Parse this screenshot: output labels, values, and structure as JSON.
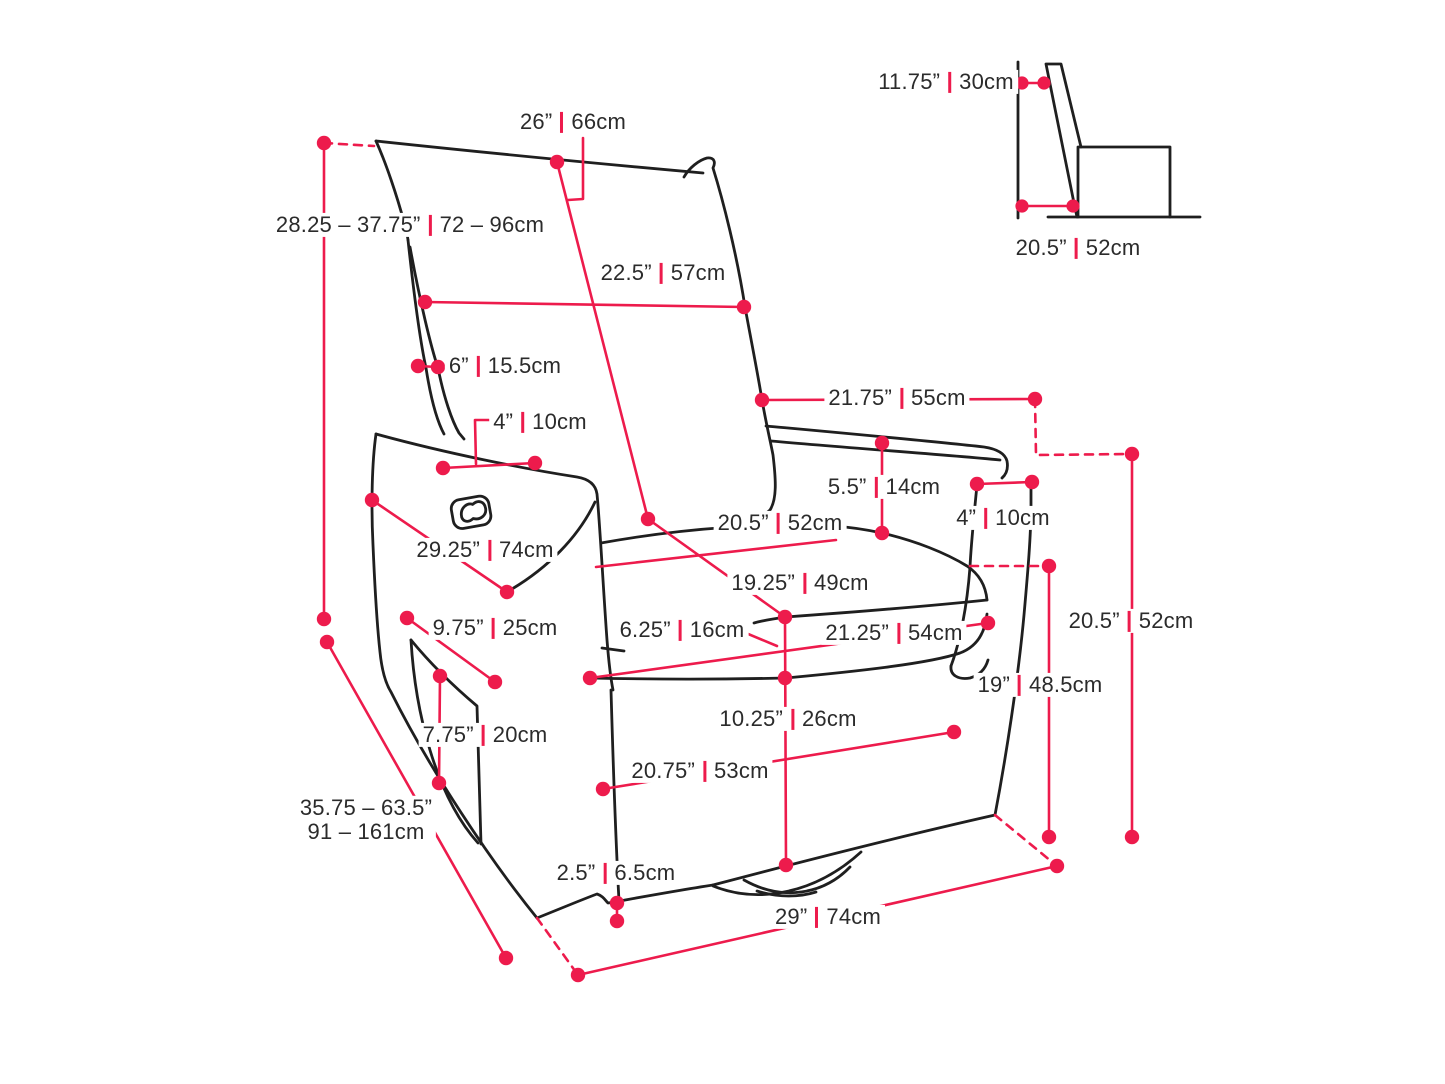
{
  "diagram_title": "recliner-chair-dimension-diagram",
  "colors": {
    "dimension_accent": "#ED1B4C",
    "outline": "#1f1f1f",
    "background": "#ffffff",
    "text": "#2b2b2b"
  },
  "labels": {
    "backrest_width": {
      "in": "26”",
      "cm": "66cm"
    },
    "wall_clearance": {
      "in": "11.75”",
      "cm": "30cm"
    },
    "side_seat_depth": {
      "in": "20.5”",
      "cm": "52cm"
    },
    "back_height_range": {
      "in": "28.25 – 37.75”",
      "cm": "72 – 96cm"
    },
    "backrest_mid_width": {
      "in": "22.5”",
      "cm": "57cm"
    },
    "back_side_thickness": {
      "in": "6”",
      "cm": "15.5cm"
    },
    "armrest_top_width": {
      "in": "4”",
      "cm": "10cm"
    },
    "armrest_length": {
      "in": "21.75”",
      "cm": "55cm"
    },
    "arm_above_seat": {
      "in": "5.5”",
      "cm": "14cm"
    },
    "arm_front_width": {
      "in": "4”",
      "cm": "10cm"
    },
    "seat_width": {
      "in": "20.5”",
      "cm": "52cm"
    },
    "arm_front_diagonal": {
      "in": "29.25”",
      "cm": "74cm"
    },
    "seat_depth": {
      "in": "19.25”",
      "cm": "49cm"
    },
    "pocket_width": {
      "in": "9.75”",
      "cm": "25cm"
    },
    "cushion_thickness": {
      "in": "6.25”",
      "cm": "16cm"
    },
    "seat_front_width": {
      "in": "21.25”",
      "cm": "54cm"
    },
    "seat_height_right": {
      "in": "20.5”",
      "cm": "52cm"
    },
    "arm_height_floor": {
      "in": "19”",
      "cm": "48.5cm"
    },
    "pocket_height": {
      "in": "7.75”",
      "cm": "20cm"
    },
    "base_front_height": {
      "in": "10.25”",
      "cm": "26cm"
    },
    "base_side_length": {
      "in": "20.75”",
      "cm": "53cm"
    },
    "extended_length_range": {
      "line1": "35.75 – 63.5”",
      "line2": "91 – 161cm"
    },
    "bottom_clearance": {
      "in": "2.5”",
      "cm": "6.5cm"
    },
    "overall_front_width": {
      "in": "29”",
      "cm": "74cm"
    }
  }
}
